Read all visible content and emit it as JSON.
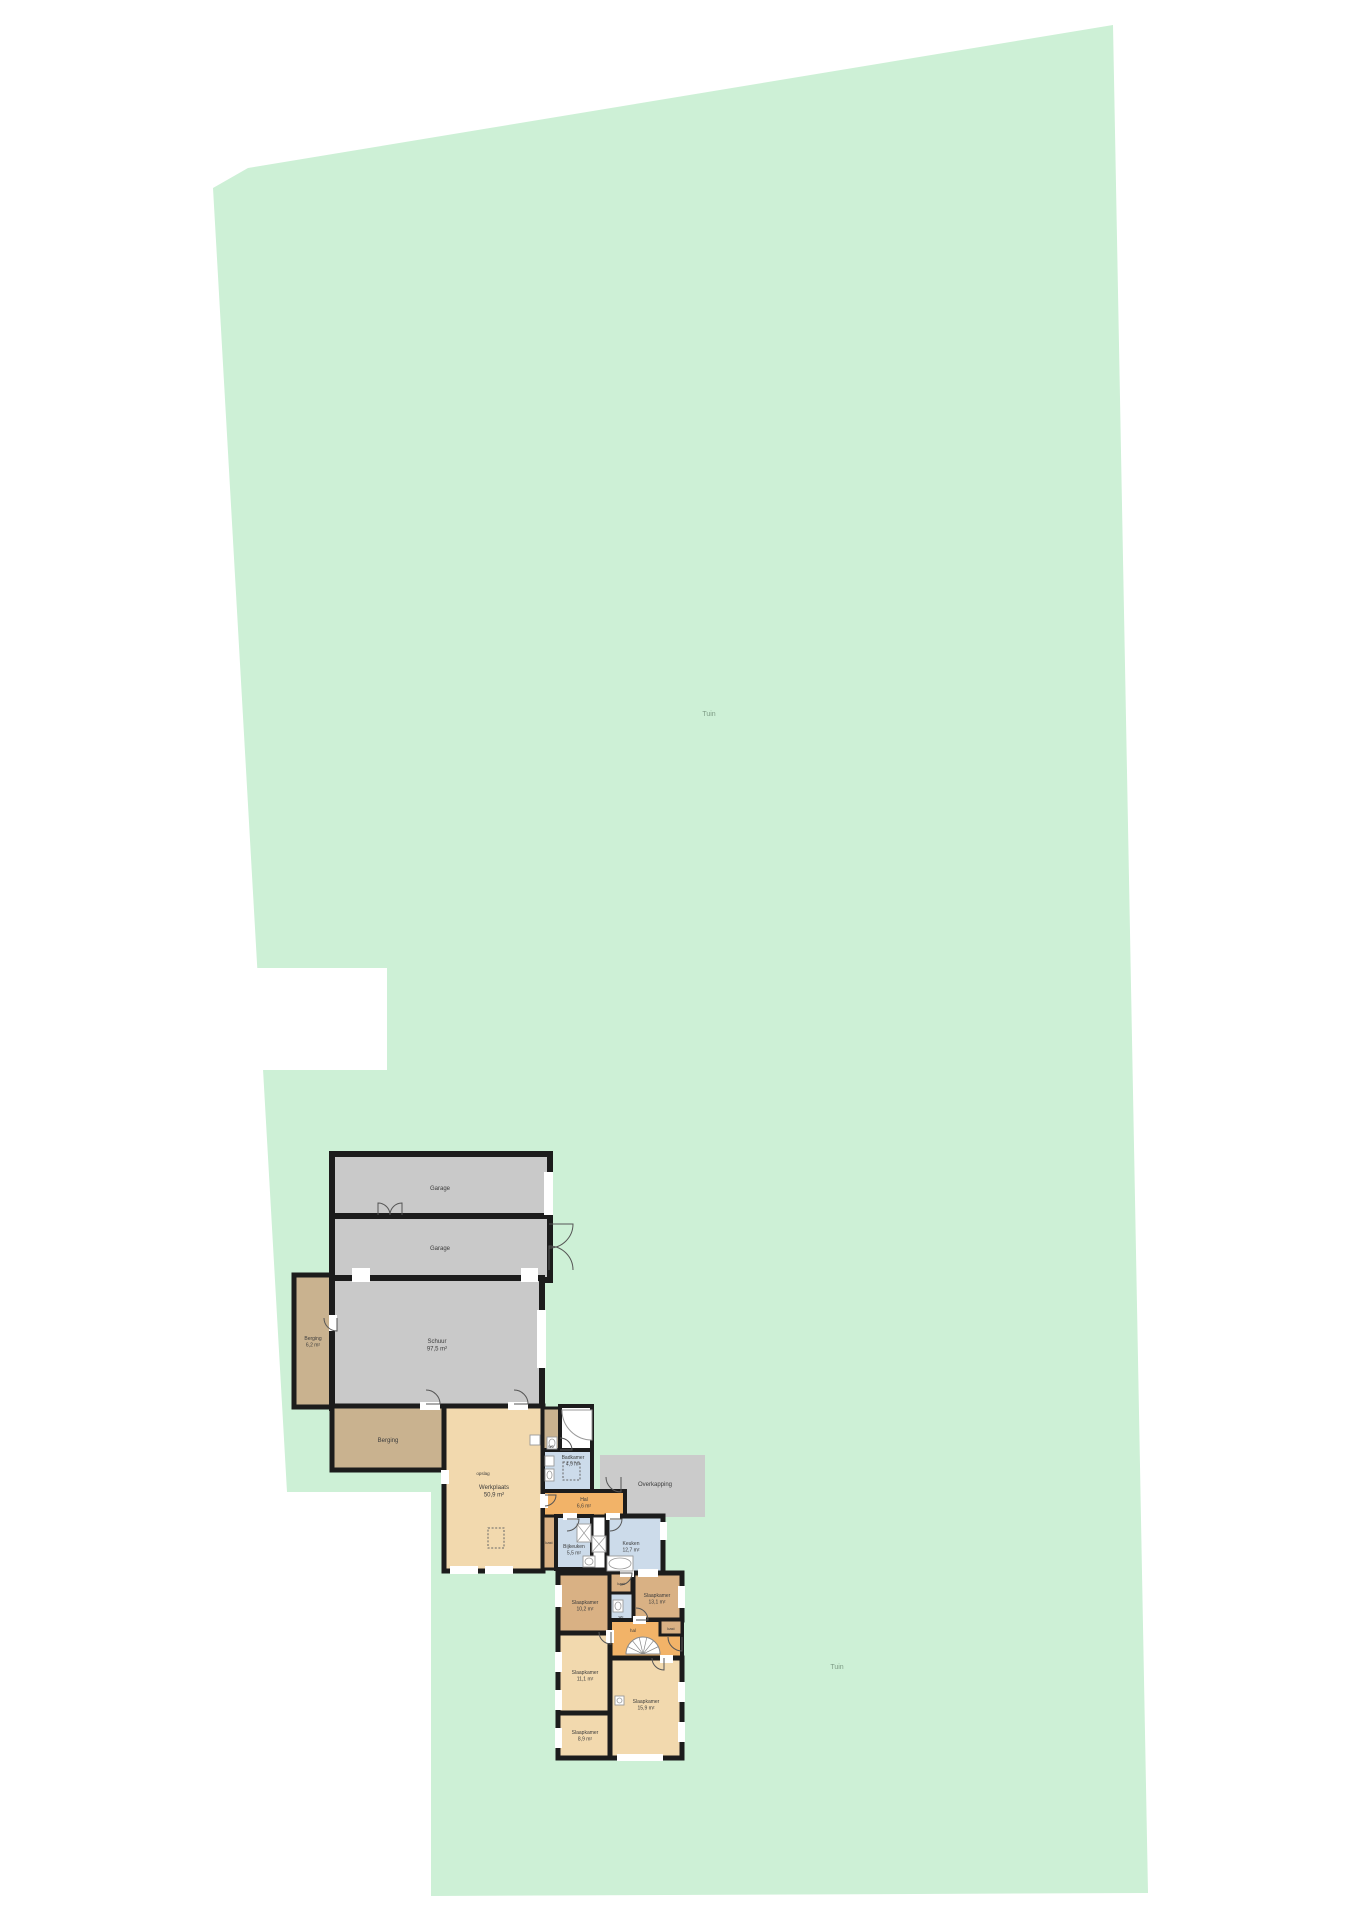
{
  "document": {
    "type": "floorplan-site-plan",
    "canvas_w": 1358,
    "canvas_h": 1920
  },
  "colors": {
    "lot_green": "#cdf0d6",
    "wall": "#1c1c1c",
    "gray_room": "#c9c9c9",
    "overkapping_gray": "#cbcbcb",
    "tan_room": "#c9b28f",
    "dark_tan_room": "#d9b184",
    "peach_room": "#f2d9ae",
    "orange_room": "#f2b368",
    "blue_room": "#ccdbea",
    "white": "#ffffff",
    "fixture_stroke": "#999999",
    "door_stroke": "#555555"
  },
  "lot": {
    "points": "213,188 248,168 1113,25 1148,1893 431,1896 431,1492 287,1492",
    "notch": {
      "x": 250,
      "y": 968,
      "w": 137,
      "h": 102
    }
  },
  "garden_labels": [
    {
      "text": "Tuin",
      "x": 709,
      "y": 716
    },
    {
      "text": "Tuin",
      "x": 837,
      "y": 1669
    }
  ],
  "rooms": [
    {
      "name": "garage-1",
      "x": 332,
      "y": 1154,
      "w": 218,
      "h": 64,
      "fill": "gray_room",
      "sw": 6,
      "label": [
        "Garage"
      ],
      "lx": 440,
      "ly": 1190,
      "fs": 6
    },
    {
      "name": "garage-2",
      "x": 332,
      "y": 1216,
      "w": 218,
      "h": 64,
      "fill": "gray_room",
      "sw": 6,
      "label": [
        "Garage"
      ],
      "lx": 440,
      "ly": 1250,
      "fs": 6
    },
    {
      "name": "berging-1",
      "x": 294,
      "y": 1275,
      "w": 38,
      "h": 132,
      "fill": "tan_room",
      "sw": 5,
      "label": [
        "Berging",
        "6,2 m²"
      ],
      "lx": 313,
      "ly": 1340,
      "fs": 5
    },
    {
      "name": "schuur",
      "x": 332,
      "y": 1278,
      "w": 210,
      "h": 130,
      "fill": "gray_room",
      "sw": 6,
      "label": [
        "Schuur",
        "97,5 m²"
      ],
      "lx": 437,
      "ly": 1343,
      "fs": 6
    },
    {
      "name": "berging-2",
      "x": 332,
      "y": 1406,
      "w": 112,
      "h": 64,
      "fill": "tan_room",
      "sw": 5,
      "label": [
        "Berging"
      ],
      "lx": 388,
      "ly": 1442,
      "fs": 6
    },
    {
      "name": "werkplaats",
      "x": 444,
      "y": 1406,
      "w": 99,
      "h": 165,
      "fill": "peach_room",
      "sw": 5,
      "label": [
        "Werkplaats",
        "50,9 m²"
      ],
      "lx": 494,
      "ly": 1489,
      "fs": 6
    },
    {
      "name": "overkapping",
      "x": 600,
      "y": 1455,
      "w": 105,
      "h": 62,
      "fill": "overkapping_gray",
      "sw": 0,
      "label": [
        "Overkapping"
      ],
      "lx": 655,
      "ly": 1486,
      "fs": 6
    },
    {
      "name": "wc-1",
      "x": 543,
      "y": 1408,
      "w": 17,
      "h": 42,
      "fill": "tan_room",
      "sw": 3,
      "label": [
        "wc"
      ],
      "lx": 551,
      "ly": 1448,
      "fs": 4.5
    },
    {
      "name": "doucheruimte",
      "x": 560,
      "y": 1406,
      "w": 32,
      "h": 46,
      "fill": "white",
      "sw": 4,
      "label": [],
      "lx": 576,
      "ly": 1430,
      "fs": 5
    },
    {
      "name": "badkamer",
      "x": 543,
      "y": 1450,
      "w": 49,
      "h": 42,
      "fill": "blue_room",
      "sw": 4,
      "label": [
        "Badkamer",
        "4,9 m²"
      ],
      "lx": 573,
      "ly": 1459,
      "fs": 5
    },
    {
      "name": "hal-1",
      "x": 543,
      "y": 1491,
      "w": 82,
      "h": 26,
      "fill": "orange_room",
      "sw": 4,
      "label": [
        "Hal",
        "6,6 m²"
      ],
      "lx": 584,
      "ly": 1501,
      "fs": 5
    },
    {
      "name": "kast-1",
      "x": 543,
      "y": 1516,
      "w": 13,
      "h": 53,
      "fill": "dark_tan_room",
      "sw": 3,
      "label": [
        "kast"
      ],
      "lx": 549,
      "ly": 1544,
      "fs": 4
    },
    {
      "name": "bijkeuken",
      "x": 556,
      "y": 1516,
      "w": 36,
      "h": 53,
      "fill": "blue_room",
      "sw": 4,
      "label": [
        "Bijkeuken",
        "5,5 m²"
      ],
      "lx": 574,
      "ly": 1548,
      "fs": 5
    },
    {
      "name": "kastenwand",
      "x": 592,
      "y": 1516,
      "w": 15,
      "h": 53,
      "fill": "white",
      "sw": 3,
      "label": [],
      "lx": 599,
      "ly": 1542,
      "fs": 5
    },
    {
      "name": "keuken",
      "x": 607,
      "y": 1516,
      "w": 56,
      "h": 57,
      "fill": "blue_room",
      "sw": 5,
      "label": [
        "Keuken",
        "12,7 m²"
      ],
      "lx": 631,
      "ly": 1545,
      "fs": 5
    },
    {
      "name": "slaapkamer-1",
      "x": 558,
      "y": 1573,
      "w": 52,
      "h": 60,
      "fill": "dark_tan_room",
      "sw": 5,
      "label": [
        "Slaapkamer",
        "10,2 m²"
      ],
      "lx": 585,
      "ly": 1604,
      "fs": 5
    },
    {
      "name": "kast-2",
      "x": 610,
      "y": 1573,
      "w": 23,
      "h": 20,
      "fill": "dark_tan_room",
      "sw": 3,
      "label": [
        "kast"
      ],
      "lx": 621,
      "ly": 1585,
      "fs": 4
    },
    {
      "name": "slaapkamer-2",
      "x": 633,
      "y": 1573,
      "w": 49,
      "h": 47,
      "fill": "dark_tan_room",
      "sw": 5,
      "label": [
        "Slaapkamer",
        "13,1 m²"
      ],
      "lx": 657,
      "ly": 1597,
      "fs": 5
    },
    {
      "name": "wc-2",
      "x": 610,
      "y": 1593,
      "w": 23,
      "h": 27,
      "fill": "blue_room",
      "sw": 3,
      "label": [
        "wc"
      ],
      "lx": 621,
      "ly": 1618,
      "fs": 4
    },
    {
      "name": "hal-2",
      "x": 610,
      "y": 1620,
      "w": 72,
      "h": 38,
      "fill": "orange_room",
      "sw": 4,
      "label": [
        "hal"
      ],
      "lx": 633,
      "ly": 1632,
      "fs": 4.5
    },
    {
      "name": "kast-3",
      "x": 660,
      "y": 1620,
      "w": 22,
      "h": 15,
      "fill": "dark_tan_room",
      "sw": 3,
      "label": [
        "kast"
      ],
      "lx": 671,
      "ly": 1630,
      "fs": 4
    },
    {
      "name": "slaapkamer-3",
      "x": 558,
      "y": 1633,
      "w": 52,
      "h": 80,
      "fill": "peach_room",
      "sw": 5,
      "label": [
        "Slaapkamer",
        "11,1 m²"
      ],
      "lx": 585,
      "ly": 1674,
      "fs": 5
    },
    {
      "name": "slaapkamer-4",
      "x": 610,
      "y": 1658,
      "w": 72,
      "h": 100,
      "fill": "peach_room",
      "sw": 5,
      "label": [
        "Slaapkamer",
        "15,9 m²"
      ],
      "lx": 646,
      "ly": 1703,
      "fs": 5
    },
    {
      "name": "slaapkamer-5",
      "x": 558,
      "y": 1713,
      "w": 52,
      "h": 45,
      "fill": "peach_room",
      "sw": 5,
      "label": [
        "Slaapkamer",
        "8,9 m²"
      ],
      "lx": 585,
      "ly": 1734,
      "fs": 5
    }
  ],
  "extra_labels": [
    {
      "text": "opslag",
      "x": 483,
      "y": 1475,
      "fs": 4.5
    }
  ],
  "openings": [
    {
      "x": 544,
      "y": 1172,
      "w": 9,
      "h": 43
    },
    {
      "x": 352,
      "y": 1268,
      "w": 18,
      "h": 14
    },
    {
      "x": 521,
      "y": 1268,
      "w": 17,
      "h": 14
    },
    {
      "x": 537,
      "y": 1310,
      "w": 9,
      "h": 58
    },
    {
      "x": 329,
      "y": 1315,
      "w": 8,
      "h": 16
    },
    {
      "x": 420,
      "y": 1402,
      "w": 20,
      "h": 8
    },
    {
      "x": 508,
      "y": 1402,
      "w": 20,
      "h": 8
    },
    {
      "x": 441,
      "y": 1470,
      "w": 8,
      "h": 14
    },
    {
      "x": 450,
      "y": 1566,
      "w": 28,
      "h": 8
    },
    {
      "x": 485,
      "y": 1566,
      "w": 28,
      "h": 8
    },
    {
      "x": 540,
      "y": 1494,
      "w": 8,
      "h": 14
    },
    {
      "x": 563,
      "y": 1513,
      "w": 14,
      "h": 7
    },
    {
      "x": 606,
      "y": 1513,
      "w": 14,
      "h": 7
    },
    {
      "x": 660,
      "y": 1522,
      "w": 7,
      "h": 18
    },
    {
      "x": 638,
      "y": 1569,
      "w": 20,
      "h": 8
    },
    {
      "x": 620,
      "y": 1569,
      "w": 14,
      "h": 8
    },
    {
      "x": 555,
      "y": 1585,
      "w": 7,
      "h": 22
    },
    {
      "x": 555,
      "y": 1652,
      "w": 7,
      "h": 20
    },
    {
      "x": 555,
      "y": 1690,
      "w": 7,
      "h": 20
    },
    {
      "x": 555,
      "y": 1728,
      "w": 7,
      "h": 20
    },
    {
      "x": 678,
      "y": 1586,
      "w": 7,
      "h": 22
    },
    {
      "x": 678,
      "y": 1682,
      "w": 7,
      "h": 20
    },
    {
      "x": 678,
      "y": 1722,
      "w": 7,
      "h": 20
    },
    {
      "x": 617,
      "y": 1754,
      "w": 46,
      "h": 7
    },
    {
      "x": 606,
      "y": 1630,
      "w": 8,
      "h": 13
    },
    {
      "x": 633,
      "y": 1616,
      "w": 13,
      "h": 8
    },
    {
      "x": 660,
      "y": 1655,
      "w": 13,
      "h": 8
    }
  ],
  "doors": [
    {
      "hx": 378,
      "hy": 1215,
      "r": 12,
      "a0": -90,
      "a1": 0
    },
    {
      "hx": 402,
      "hy": 1215,
      "r": 12,
      "a0": -90,
      "a1": -180
    },
    {
      "hx": 549,
      "hy": 1224,
      "r": 24,
      "a0": 0,
      "a1": 90
    },
    {
      "hx": 549,
      "hy": 1270,
      "r": 24,
      "a0": -90,
      "a1": 0
    },
    {
      "hx": 337,
      "hy": 1318,
      "r": 13,
      "a0": 90,
      "a1": 180
    },
    {
      "hx": 426,
      "hy": 1404,
      "r": 14,
      "a0": 0,
      "a1": -90
    },
    {
      "hx": 514,
      "hy": 1404,
      "r": 14,
      "a0": 0,
      "a1": -90
    },
    {
      "hx": 560,
      "hy": 1450,
      "r": 12,
      "a0": 0,
      "a1": -90
    },
    {
      "hx": 621,
      "hy": 1477,
      "r": 15,
      "a0": 90,
      "a1": 180
    },
    {
      "hx": 545,
      "hy": 1495,
      "r": 11,
      "a0": 0,
      "a1": 90
    },
    {
      "hx": 567,
      "hy": 1519,
      "r": 12,
      "a0": 0,
      "a1": 90
    },
    {
      "hx": 610,
      "hy": 1519,
      "r": 12,
      "a0": 0,
      "a1": 90
    },
    {
      "hx": 620,
      "hy": 1573,
      "r": 12,
      "a0": 0,
      "a1": 90
    },
    {
      "hx": 611,
      "hy": 1632,
      "r": 12,
      "a0": 90,
      "a1": 180
    },
    {
      "hx": 636,
      "hy": 1620,
      "r": 12,
      "a0": 0,
      "a1": -90
    },
    {
      "hx": 664,
      "hy": 1658,
      "r": 12,
      "a0": 90,
      "a1": 180
    },
    {
      "hx": 682,
      "hy": 1637,
      "r": 14,
      "a0": 90,
      "a1": 180
    }
  ],
  "dashed_boxes": [
    {
      "x": 488,
      "y": 1528,
      "w": 16,
      "h": 20
    },
    {
      "x": 563,
      "y": 1462,
      "w": 17,
      "h": 18
    }
  ],
  "fixtures": [
    {
      "name": "washer",
      "x": 577,
      "y": 1524,
      "w": 14,
      "h": 18,
      "cross": true
    },
    {
      "name": "dryer",
      "x": 592,
      "y": 1536,
      "w": 14,
      "h": 16,
      "cross": true
    },
    {
      "name": "sink",
      "x": 583,
      "y": 1556,
      "w": 12,
      "h": 11,
      "circle": true
    },
    {
      "name": "kitchen-sink",
      "x": 607,
      "y": 1556,
      "w": 26,
      "h": 15,
      "circle": true
    },
    {
      "name": "washbasin",
      "x": 545,
      "y": 1456,
      "w": 9,
      "h": 10
    },
    {
      "name": "toilet",
      "x": 545,
      "y": 1469,
      "w": 9,
      "h": 12,
      "circle": true
    },
    {
      "name": "toilet",
      "x": 547,
      "y": 1437,
      "w": 10,
      "h": 12,
      "circle": true
    },
    {
      "name": "washbasin",
      "x": 530,
      "y": 1435,
      "w": 10,
      "h": 10
    },
    {
      "name": "toilet",
      "x": 613,
      "y": 1600,
      "w": 10,
      "h": 12,
      "circle": true
    },
    {
      "name": "washbasin",
      "x": 615,
      "y": 1696,
      "w": 9,
      "h": 9,
      "circle": true
    }
  ],
  "shower": {
    "path": "M 592 1410 L 592 1440 A 30 30 0 0 1 562 1410 Z"
  },
  "stairs": {
    "cx": 643,
    "cy": 1654,
    "r": 17,
    "spokes": 6
  }
}
